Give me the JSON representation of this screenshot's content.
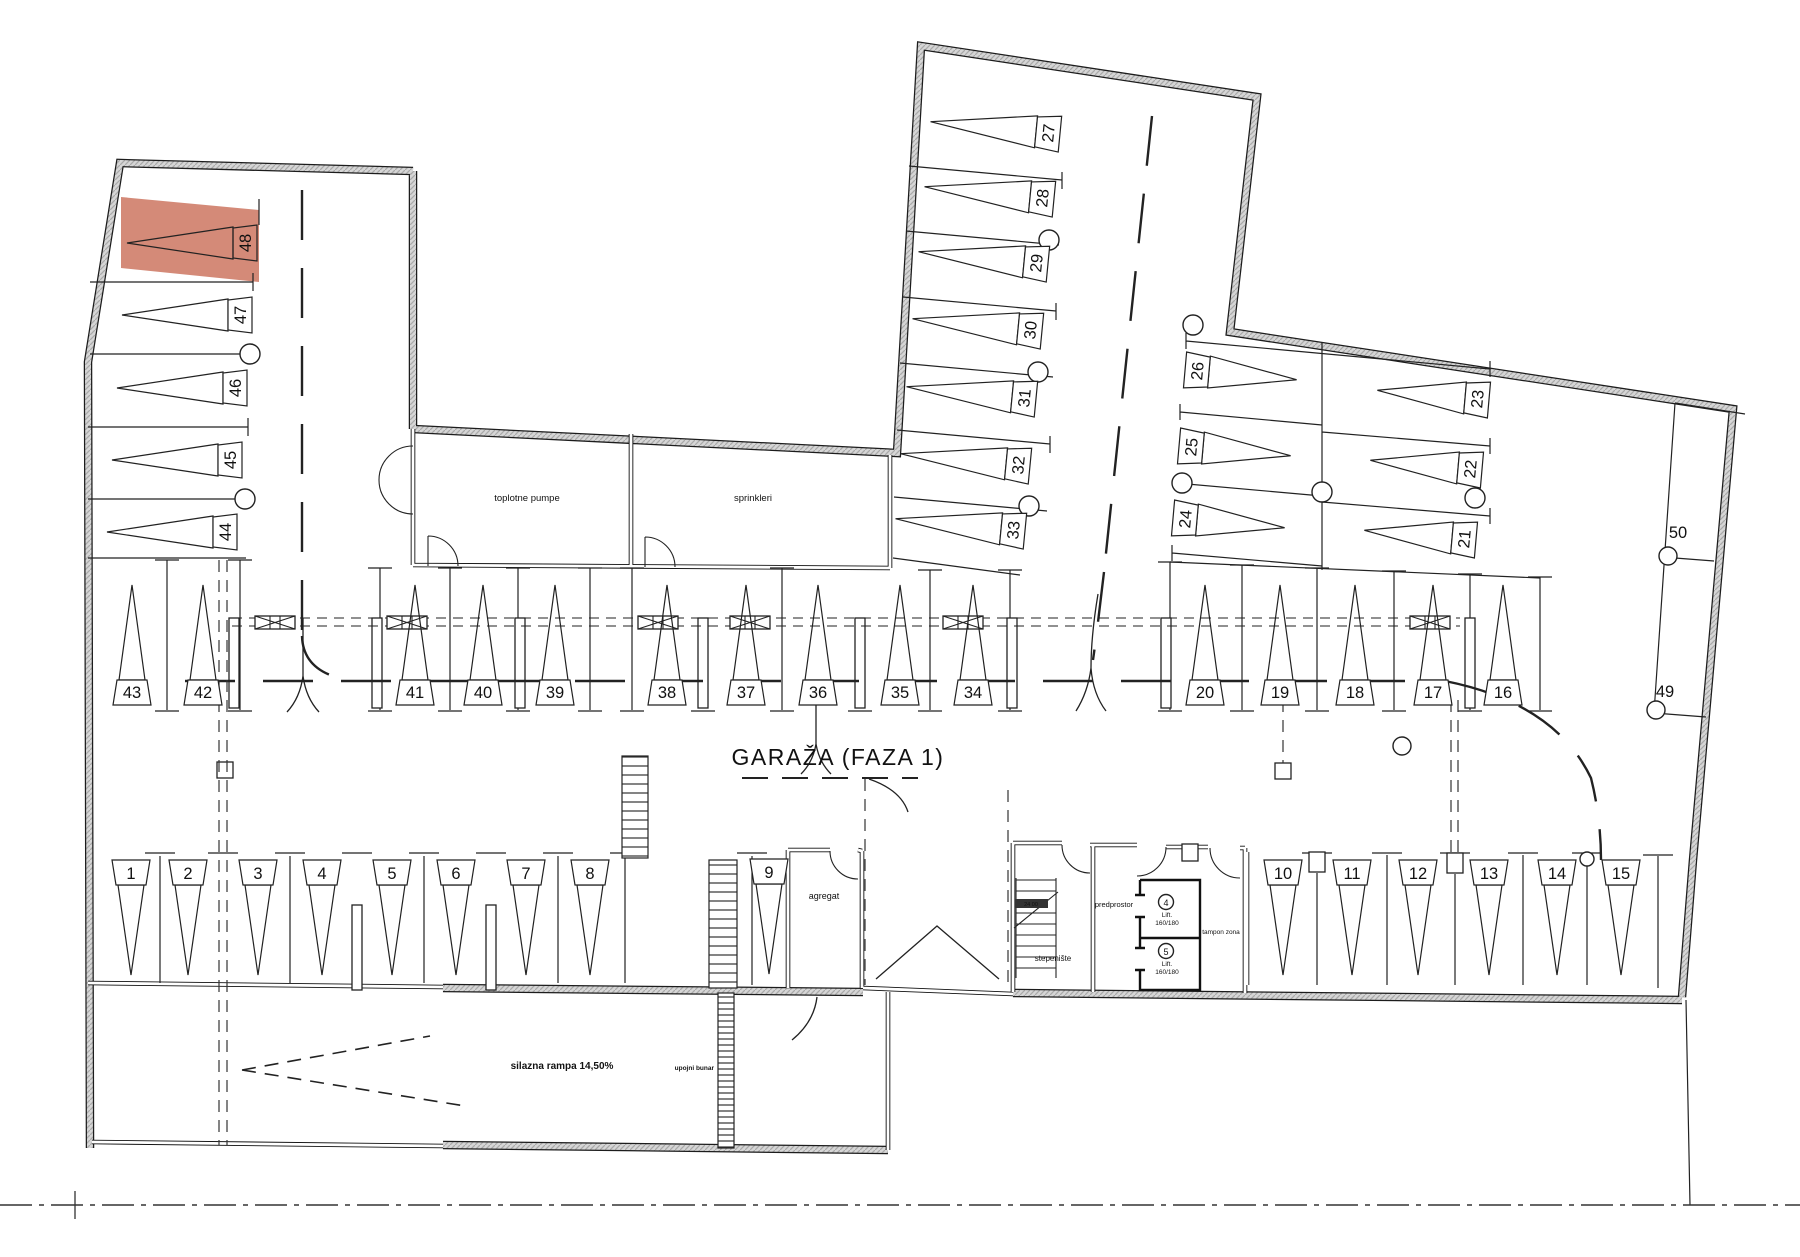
{
  "title": "GARAŽA  (FAZA 1)",
  "highlight": {
    "spot": "48",
    "color": "#d0806c"
  },
  "rooms": {
    "toplotne": "toplotne pumpe",
    "sprinkleri": "sprinkleri",
    "agregat": "agregat",
    "stepeniste": "stepenište",
    "predprostor": "predprostor",
    "tampon": "tampon zona",
    "stairs_note": "24 00"
  },
  "lifts": [
    {
      "num": "4",
      "name": "Lift.",
      "size": "160/180"
    },
    {
      "num": "5",
      "name": "Lift.",
      "size": "160/180"
    }
  ],
  "labels": {
    "ramp": "silazna rampa 14,50%",
    "well": "upojni bunar"
  },
  "spots": [
    {
      "n": "1",
      "x": 131,
      "y": 873,
      "dir": "down"
    },
    {
      "n": "2",
      "x": 188,
      "y": 873,
      "dir": "down"
    },
    {
      "n": "3",
      "x": 258,
      "y": 873,
      "dir": "down"
    },
    {
      "n": "4",
      "x": 322,
      "y": 873,
      "dir": "down"
    },
    {
      "n": "5",
      "x": 392,
      "y": 873,
      "dir": "down"
    },
    {
      "n": "6",
      "x": 456,
      "y": 873,
      "dir": "down"
    },
    {
      "n": "7",
      "x": 526,
      "y": 873,
      "dir": "down"
    },
    {
      "n": "8",
      "x": 590,
      "y": 873,
      "dir": "down"
    },
    {
      "n": "9",
      "x": 769,
      "y": 872,
      "dir": "down"
    },
    {
      "n": "10",
      "x": 1283,
      "y": 873,
      "dir": "down"
    },
    {
      "n": "11",
      "x": 1352,
      "y": 873,
      "dir": "down"
    },
    {
      "n": "12",
      "x": 1418,
      "y": 873,
      "dir": "down"
    },
    {
      "n": "13",
      "x": 1489,
      "y": 873,
      "dir": "down"
    },
    {
      "n": "14",
      "x": 1557,
      "y": 873,
      "dir": "down"
    },
    {
      "n": "15",
      "x": 1621,
      "y": 873,
      "dir": "down"
    },
    {
      "n": "16",
      "x": 1503,
      "y": 692,
      "dir": "up"
    },
    {
      "n": "17",
      "x": 1433,
      "y": 692,
      "dir": "up"
    },
    {
      "n": "18",
      "x": 1355,
      "y": 692,
      "dir": "up"
    },
    {
      "n": "19",
      "x": 1280,
      "y": 692,
      "dir": "up"
    },
    {
      "n": "20",
      "x": 1205,
      "y": 692,
      "dir": "up"
    },
    {
      "n": "21",
      "x": 1464,
      "y": 539,
      "dir": "left",
      "rot": 5,
      "len": 100
    },
    {
      "n": "22",
      "x": 1470,
      "y": 469,
      "dir": "left",
      "rot": 5,
      "len": 100
    },
    {
      "n": "23",
      "x": 1477,
      "y": 399,
      "dir": "left",
      "rot": 5,
      "len": 100
    },
    {
      "n": "24",
      "x": 1185,
      "y": 519,
      "dir": "right",
      "rot": 5,
      "len": 100
    },
    {
      "n": "25",
      "x": 1191,
      "y": 447,
      "dir": "right",
      "rot": 5,
      "len": 100
    },
    {
      "n": "26",
      "x": 1197,
      "y": 371,
      "dir": "right",
      "rot": 5,
      "len": 100
    },
    {
      "n": "27",
      "x": 1048,
      "y": 133,
      "dir": "left",
      "rot": 5.5
    },
    {
      "n": "28",
      "x": 1042,
      "y": 198,
      "dir": "left",
      "rot": 5.5
    },
    {
      "n": "29",
      "x": 1036,
      "y": 263,
      "dir": "left",
      "rot": 5.5
    },
    {
      "n": "30",
      "x": 1030,
      "y": 330,
      "dir": "left",
      "rot": 5.5
    },
    {
      "n": "31",
      "x": 1024,
      "y": 398,
      "dir": "left",
      "rot": 5.5
    },
    {
      "n": "32",
      "x": 1018,
      "y": 465,
      "dir": "left",
      "rot": 5.5
    },
    {
      "n": "33",
      "x": 1013,
      "y": 530,
      "dir": "left",
      "rot": 5.5
    },
    {
      "n": "34",
      "x": 973,
      "y": 692,
      "dir": "up"
    },
    {
      "n": "35",
      "x": 900,
      "y": 692,
      "dir": "up"
    },
    {
      "n": "36",
      "x": 818,
      "y": 692,
      "dir": "up"
    },
    {
      "n": "37",
      "x": 746,
      "y": 692,
      "dir": "up"
    },
    {
      "n": "38",
      "x": 667,
      "y": 692,
      "dir": "up"
    },
    {
      "n": "39",
      "x": 555,
      "y": 692,
      "dir": "up"
    },
    {
      "n": "40",
      "x": 483,
      "y": 692,
      "dir": "up"
    },
    {
      "n": "41",
      "x": 415,
      "y": 692,
      "dir": "up"
    },
    {
      "n": "42",
      "x": 203,
      "y": 692,
      "dir": "up"
    },
    {
      "n": "43",
      "x": 132,
      "y": 692,
      "dir": "up"
    },
    {
      "n": "44",
      "x": 225,
      "y": 532,
      "dir": "left"
    },
    {
      "n": "45",
      "x": 230,
      "y": 460,
      "dir": "left"
    },
    {
      "n": "46",
      "x": 235,
      "y": 388,
      "dir": "left"
    },
    {
      "n": "47",
      "x": 240,
      "y": 315,
      "dir": "left"
    },
    {
      "n": "48",
      "x": 245,
      "y": 243,
      "dir": "left",
      "highlight": true
    },
    {
      "n": "49",
      "x": 1665,
      "y": 697,
      "dir": "plain"
    },
    {
      "n": "50",
      "x": 1678,
      "y": 538,
      "dir": "plain"
    }
  ]
}
